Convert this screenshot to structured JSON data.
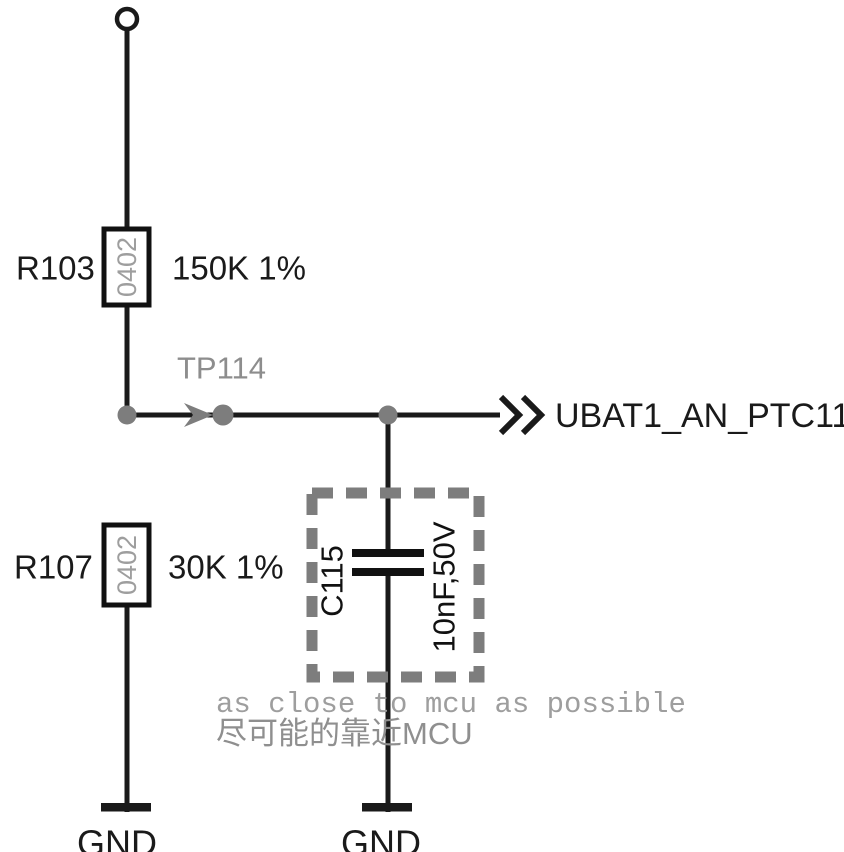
{
  "colors": {
    "wire_black": "#1a1a1a",
    "symbol_gray": "#7d7d7d",
    "package_text_gray": "#9e9e9e",
    "note_gray": "#9e9e9e"
  },
  "components": {
    "r103": {
      "ref": "R103",
      "package": "0402",
      "value": "150K 1%"
    },
    "r107": {
      "ref": "R107",
      "package": "0402",
      "value": "30K 1%"
    },
    "c115": {
      "ref": "C115",
      "value": "10nF,50V"
    },
    "tp114": {
      "ref": "TP114"
    }
  },
  "net_label": "UBAT1_AN_PTC11",
  "grounds": {
    "left": "GND",
    "right": "GND"
  },
  "notes": {
    "english": "as close to mcu as possible",
    "chinese": "尽可能的靠近MCU"
  }
}
